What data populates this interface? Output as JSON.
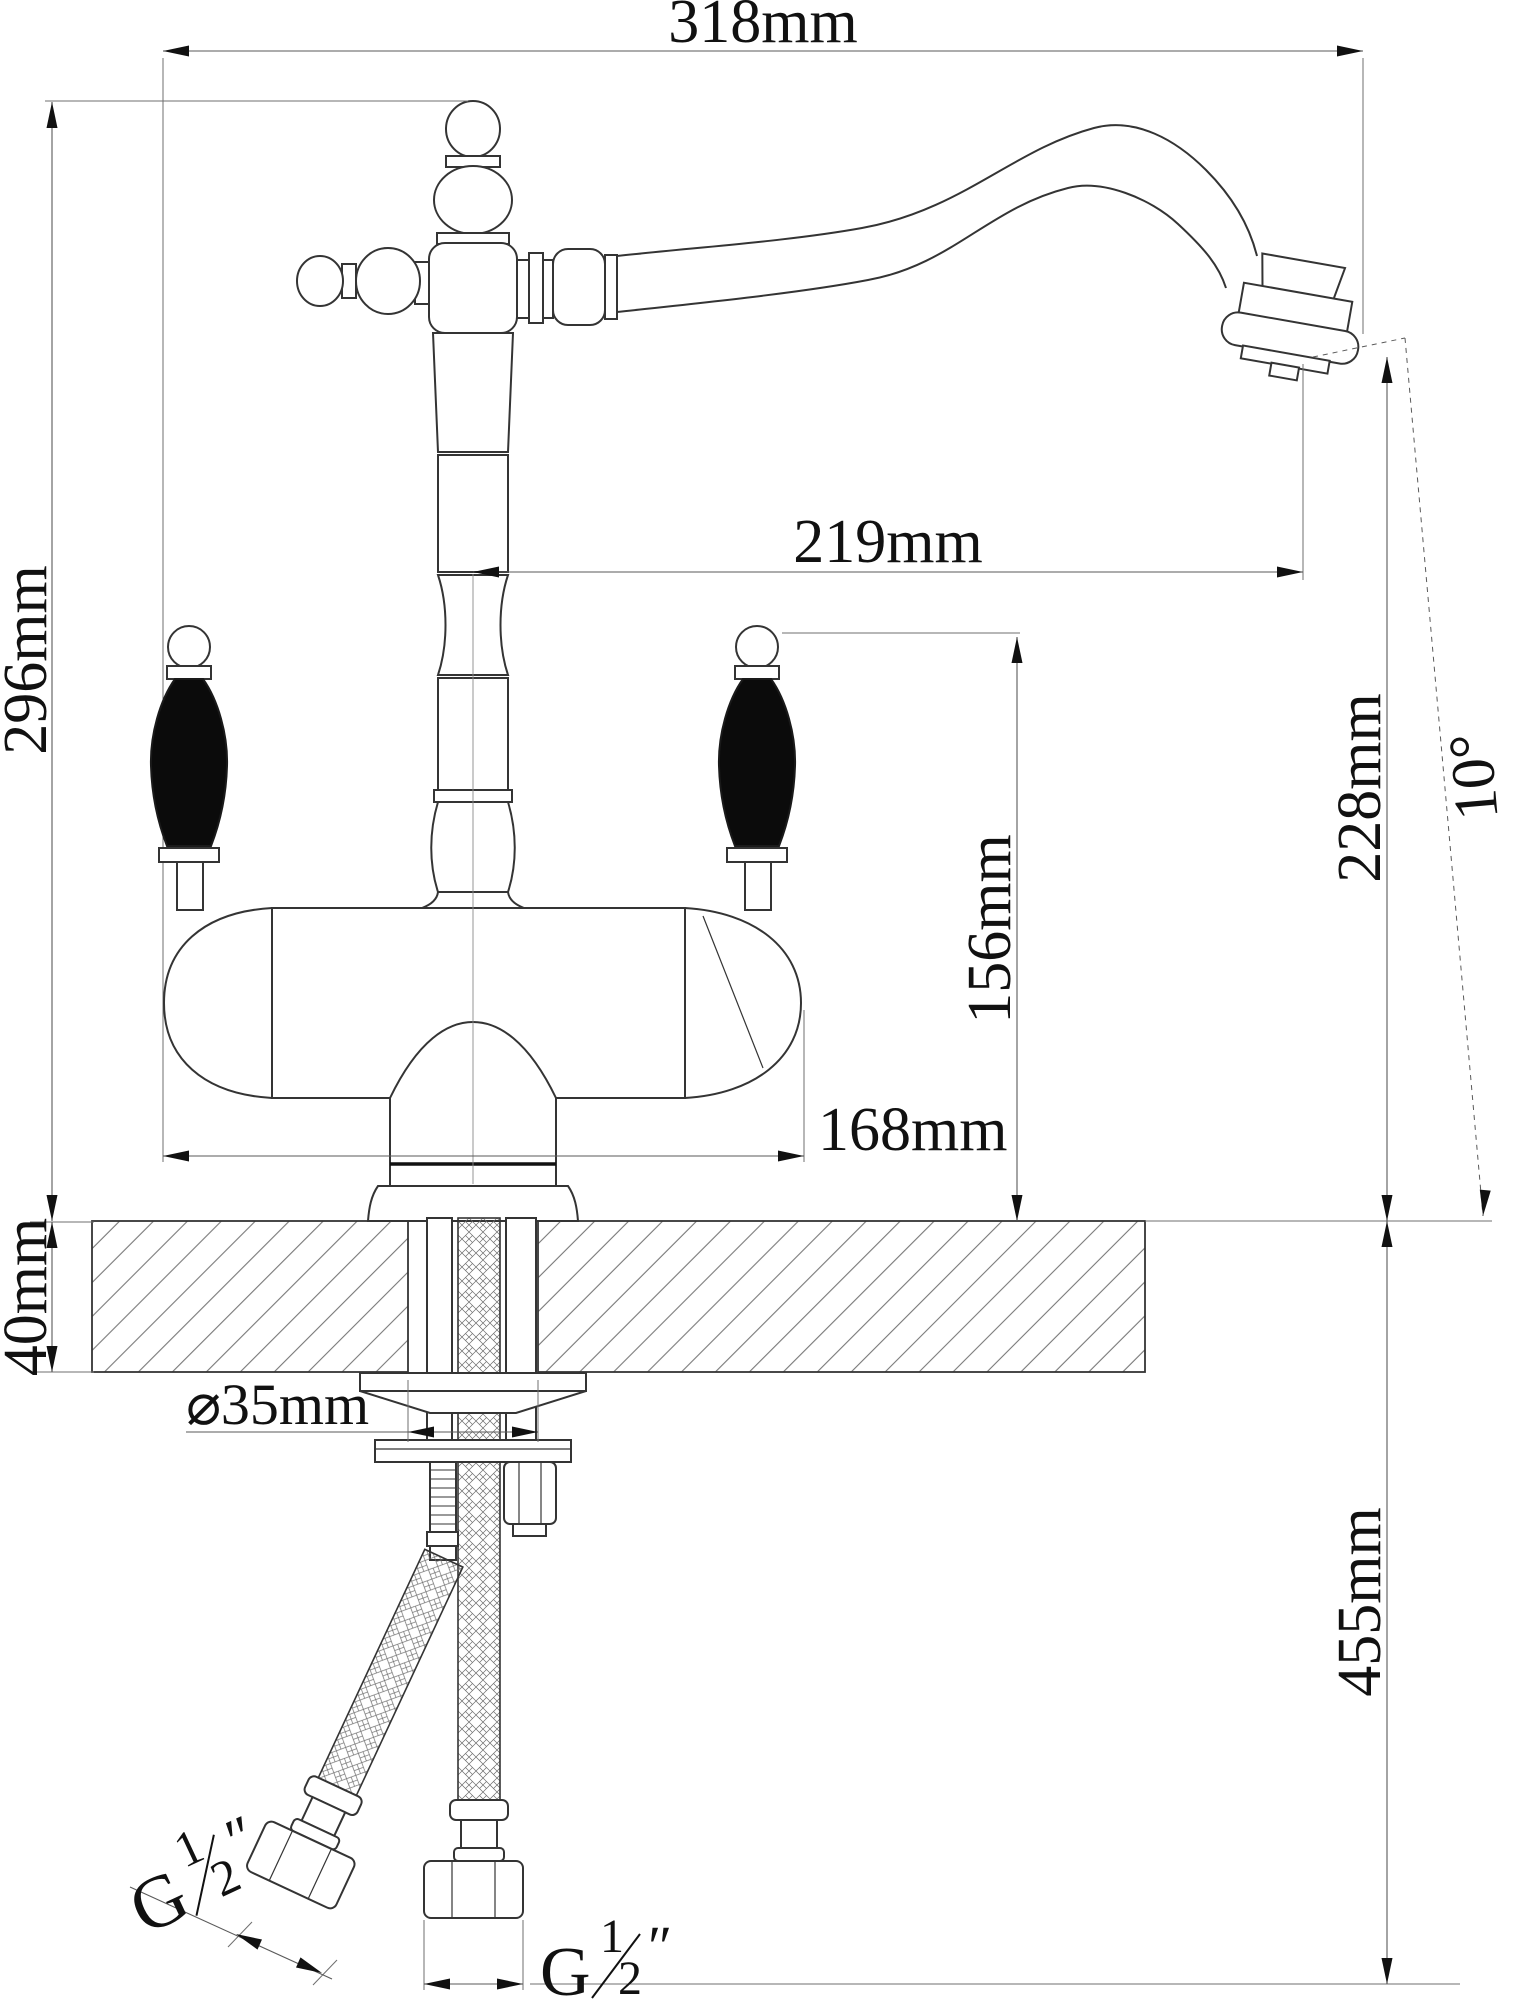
{
  "drawing": {
    "dimensions": {
      "overall_width": "318mm",
      "overall_height": "296mm",
      "spout_reach": "219mm",
      "outlet_height": "228mm",
      "outlet_angle": "10°",
      "handle_height": "156mm",
      "body_width": "168mm",
      "counter_thickness": "40mm",
      "hole_diameter": "⌀35mm",
      "below_counter_length": "455mm"
    },
    "thread": {
      "letter": "G",
      "numerator": "1",
      "denominator": "2",
      "unit": "″"
    }
  }
}
